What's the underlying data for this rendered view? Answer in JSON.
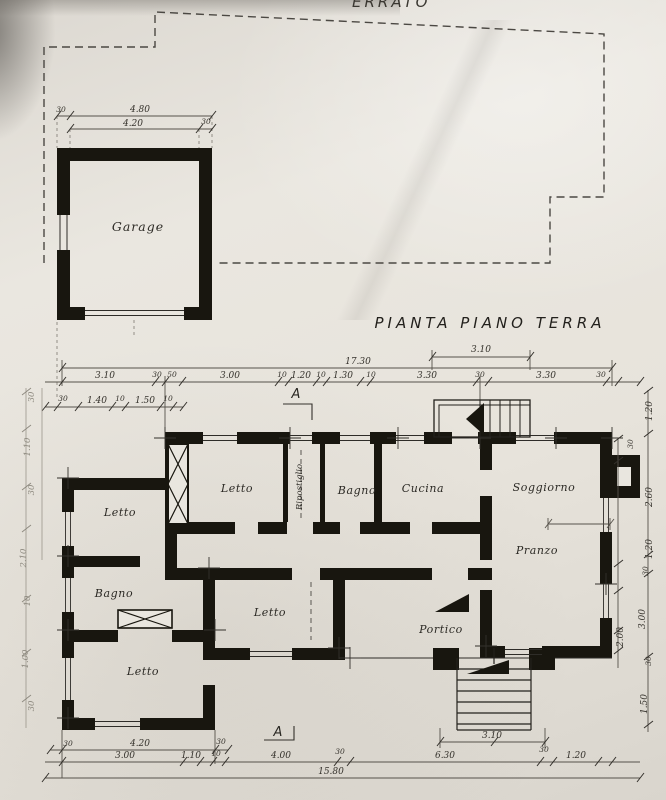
{
  "colors": {
    "paper": "#e9e6df",
    "ink": "#18160f",
    "dim_line": "#56524b",
    "faint": "#8d897f"
  },
  "header": {
    "partial_text": "ERRATO",
    "title": "PIANTA  PIANO  TERRA"
  },
  "markers": {
    "section_top": "A",
    "section_bottom": "A"
  },
  "rooms": {
    "garage": "Garage",
    "letto_top": "Letto",
    "ripostiglio": "Ripostiglio",
    "bagno_top": "Bagno",
    "cucina": "Cucina",
    "soggiorno": "Soggiorno",
    "pranzo": "Pranzo",
    "letto_left": "Letto",
    "bagno_left": "Bagno",
    "letto_center": "Letto",
    "letto_bottom": "Letto",
    "portico": "Portico"
  },
  "dims": {
    "garage_row1": [
      "30",
      "4.80"
    ],
    "garage_row2": [
      "4.20",
      "30"
    ],
    "upper_short": "3.10",
    "top_total": "17.30",
    "top_row": [
      "3.10",
      "30",
      "50",
      "3.00",
      "10",
      "1.20",
      "10",
      "1.30",
      "10",
      "3.30",
      "30",
      "3.30",
      "30"
    ],
    "top_sub": [
      "30",
      "1.40",
      "10",
      "1.50",
      "10"
    ],
    "left_col": [
      "30",
      "1.10",
      "30",
      "2.10",
      "10",
      "1.00",
      "30"
    ],
    "right_col": [
      "1.20",
      "30",
      "2.60",
      "1.20",
      "30",
      "3.00",
      "2.00",
      "30",
      "1.50"
    ],
    "bottom_short": "3.10",
    "bottom_row1": [
      "30",
      "4.20",
      "30"
    ],
    "bottom_row2": [
      "3.00",
      "1.10",
      "10",
      "4.00",
      "30",
      "6.30",
      "30",
      "1.20"
    ],
    "bottom_total": "15.80"
  }
}
